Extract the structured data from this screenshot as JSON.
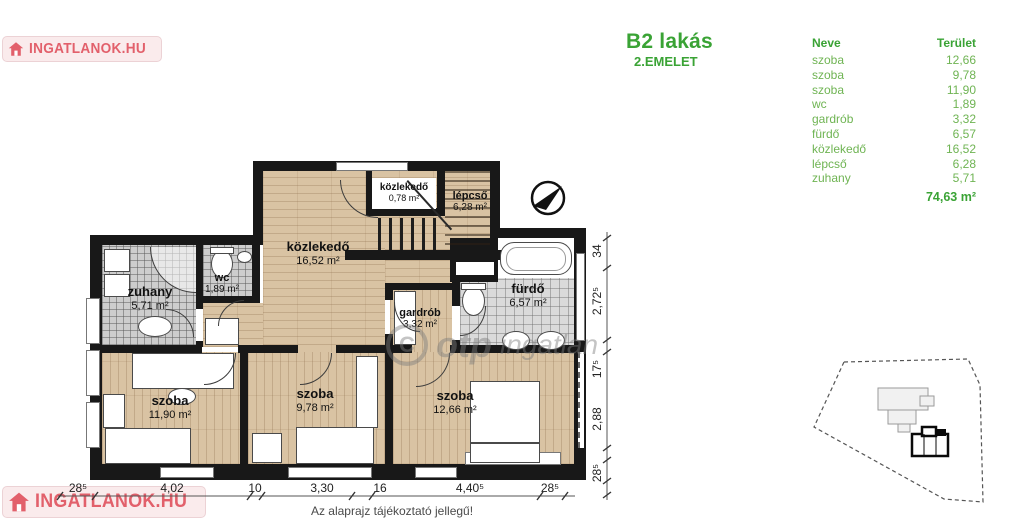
{
  "header": {
    "title": "B2 lakás",
    "subtitle": "2.EMELET"
  },
  "table": {
    "columns": {
      "name": "Neve",
      "area": "Terület"
    },
    "rows": [
      {
        "name": "szoba",
        "area": "12,66"
      },
      {
        "name": "szoba",
        "area": "9,78"
      },
      {
        "name": "szoba",
        "area": "11,90"
      },
      {
        "name": "wc",
        "area": "1,89"
      },
      {
        "name": "gardrób",
        "area": "3,32"
      },
      {
        "name": "fürdő",
        "area": "6,57"
      },
      {
        "name": "közlekedő",
        "area": "16,52"
      },
      {
        "name": "lépcső",
        "area": "6,28"
      },
      {
        "name": "zuhany",
        "area": "5,71"
      }
    ],
    "total": "74,63 m²"
  },
  "plan": {
    "rooms": [
      {
        "label": "közlekedő",
        "area": "16,52 m²"
      },
      {
        "label": "közlekedő",
        "area": "0,78 m²"
      },
      {
        "label": "lépcső",
        "area": "6,28 m²"
      },
      {
        "label": "zuhany",
        "area": "5,71 m²"
      },
      {
        "label": "wc",
        "area": "1,89 m²"
      },
      {
        "label": "fürdő",
        "area": "6,57 m²"
      },
      {
        "label": "gardrób",
        "area": "3,32 m²"
      },
      {
        "label": "szoba",
        "area": "11,90 m²"
      },
      {
        "label": "szoba",
        "area": "9,78 m²"
      },
      {
        "label": "szoba",
        "area": "12,66 m²"
      }
    ],
    "dims_bottom": [
      "28⁵",
      "4,02",
      "10",
      "3,30",
      "16",
      "4,40⁵",
      "28⁵"
    ],
    "dims_right": [
      "34",
      "2,72⁵",
      "17⁵",
      "2,88",
      "28⁵"
    ],
    "note": "Az alaprajz tájékoztató jellegű!"
  },
  "watermarks": {
    "brand": "INGATLANOK.HU",
    "otp_c": "C",
    "otp_bold": "otp",
    "otp_rest": "ingatlan"
  },
  "colors": {
    "green": "#3aa335",
    "green_light": "#6fb453",
    "brand_red": "#e2606b"
  }
}
